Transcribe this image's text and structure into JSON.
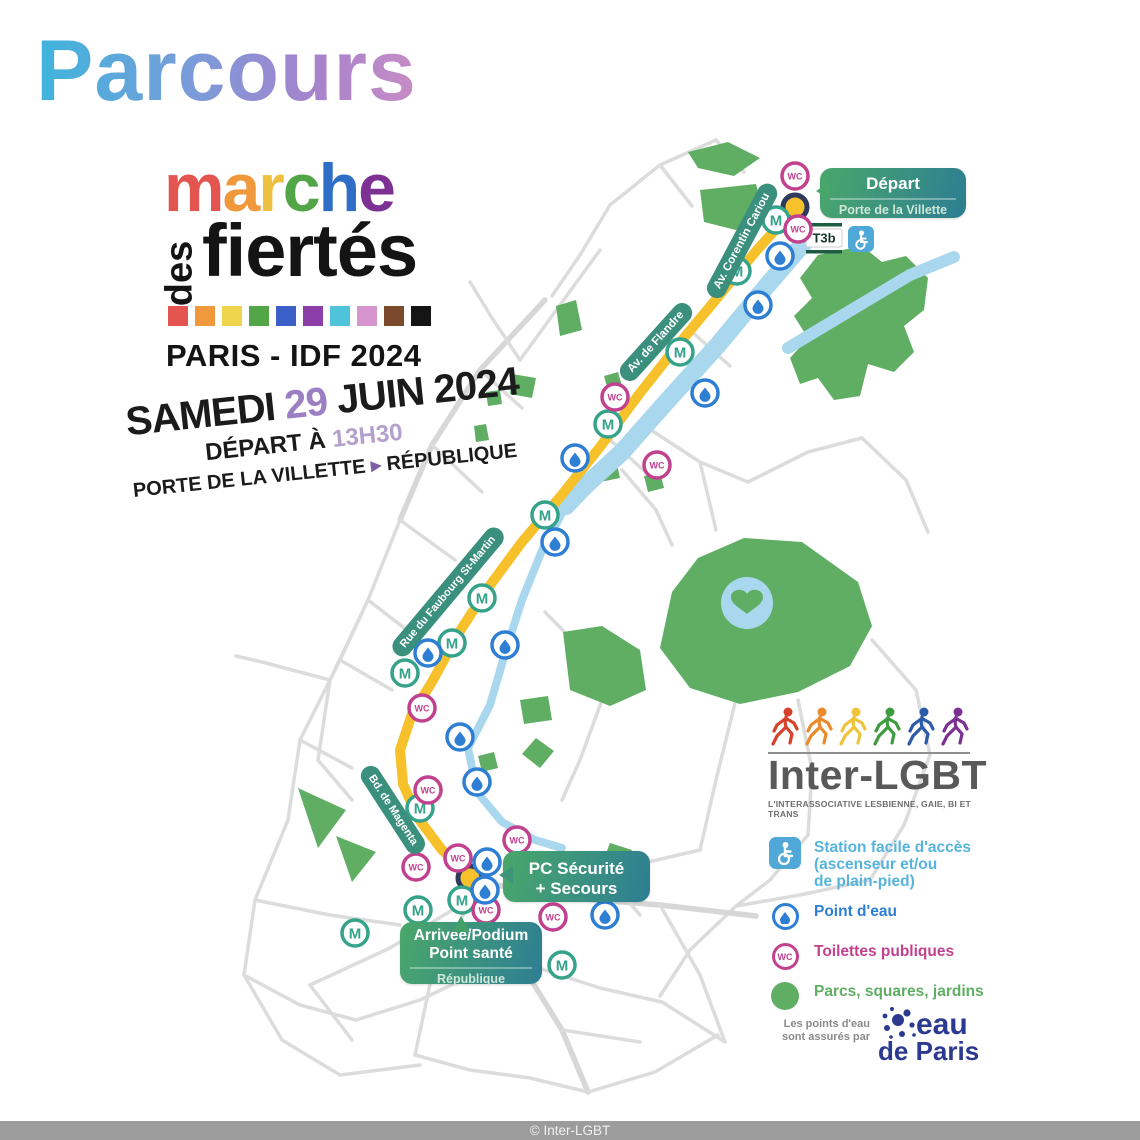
{
  "title": "Parcours",
  "logo": {
    "marche": [
      {
        "ch": "m",
        "color": "#e3554e"
      },
      {
        "ch": "a",
        "color": "#f0993c"
      },
      {
        "ch": "r",
        "color": "#eec03f"
      },
      {
        "ch": "c",
        "color": "#53a647"
      },
      {
        "ch": "h",
        "color": "#2e6ec6"
      },
      {
        "ch": "e",
        "color": "#7d3193"
      }
    ],
    "des": "des",
    "fiertes": "fiertés",
    "squares": [
      "#e3554e",
      "#f0993c",
      "#efd54d",
      "#53a647",
      "#3a5fc6",
      "#8d3fa9",
      "#4fc3d9",
      "#d795cf",
      "#7b4a2c",
      "#151515"
    ],
    "subtitle": "PARIS - IDF 2024"
  },
  "event": {
    "day_word": "SAMEDI",
    "day_num": "29",
    "day_num_color": "#9c7fc2",
    "date_rest": "JUIN 2024",
    "start_label": "DÉPART À",
    "start_time": "13H30",
    "time_color": "#b5a0cd",
    "from": "PORTE DE LA VILLETTE",
    "arrow": "▸",
    "arrow_color": "#7d5fa5",
    "to": "RÉPUBLIQUE"
  },
  "map": {
    "icons": {
      "metro": "M",
      "wc": "WC",
      "tram": "T3b"
    },
    "streets": {
      "corentin": "Av. Corentin Cariou",
      "flandre": "Av. de Flandre",
      "faubourg": "Rue du Faubourg St-Martin",
      "magenta": "Bd. de Magenta"
    },
    "badges": {
      "depart": {
        "title": "Départ",
        "subtitle": "Porte de la Villette"
      },
      "pc": {
        "line1": "PC Sécurité",
        "line2": "+ Secours"
      },
      "arrivee": {
        "line1": "Arrivée/Podium",
        "line2": "Point santé",
        "subtitle": "République"
      }
    },
    "route_color": "#f6c12b",
    "park_color": "#5fae63",
    "water_color": "#a9d7ee"
  },
  "legend": {
    "brand": "Inter-LGBT",
    "tagline": "L'INTERASSOCIATIVE LESBIENNE, GAIE, BI ET TRANS",
    "runner_colors": [
      "#d6412b",
      "#e98a2b",
      "#efc43b",
      "#3e9b3f",
      "#2c5ba8",
      "#7d3091"
    ],
    "items": [
      {
        "label": "Station facile d'accès\n(ascenseur et/ou\nde plain-pied)",
        "color": "#56b4dc"
      },
      {
        "label": "Point d'eau",
        "color": "#2e7fd4"
      },
      {
        "label": "Toilettes publiques",
        "color": "#c2418f"
      },
      {
        "label": "Parcs, squares, jardins",
        "color": "#5fae63"
      }
    ],
    "sponsor_note": "Les points d'eau\nsont assurés par",
    "sponsor_line1": "eau",
    "sponsor_line2": "de Paris"
  },
  "footer": {
    "credit": "© Inter-LGBT"
  }
}
